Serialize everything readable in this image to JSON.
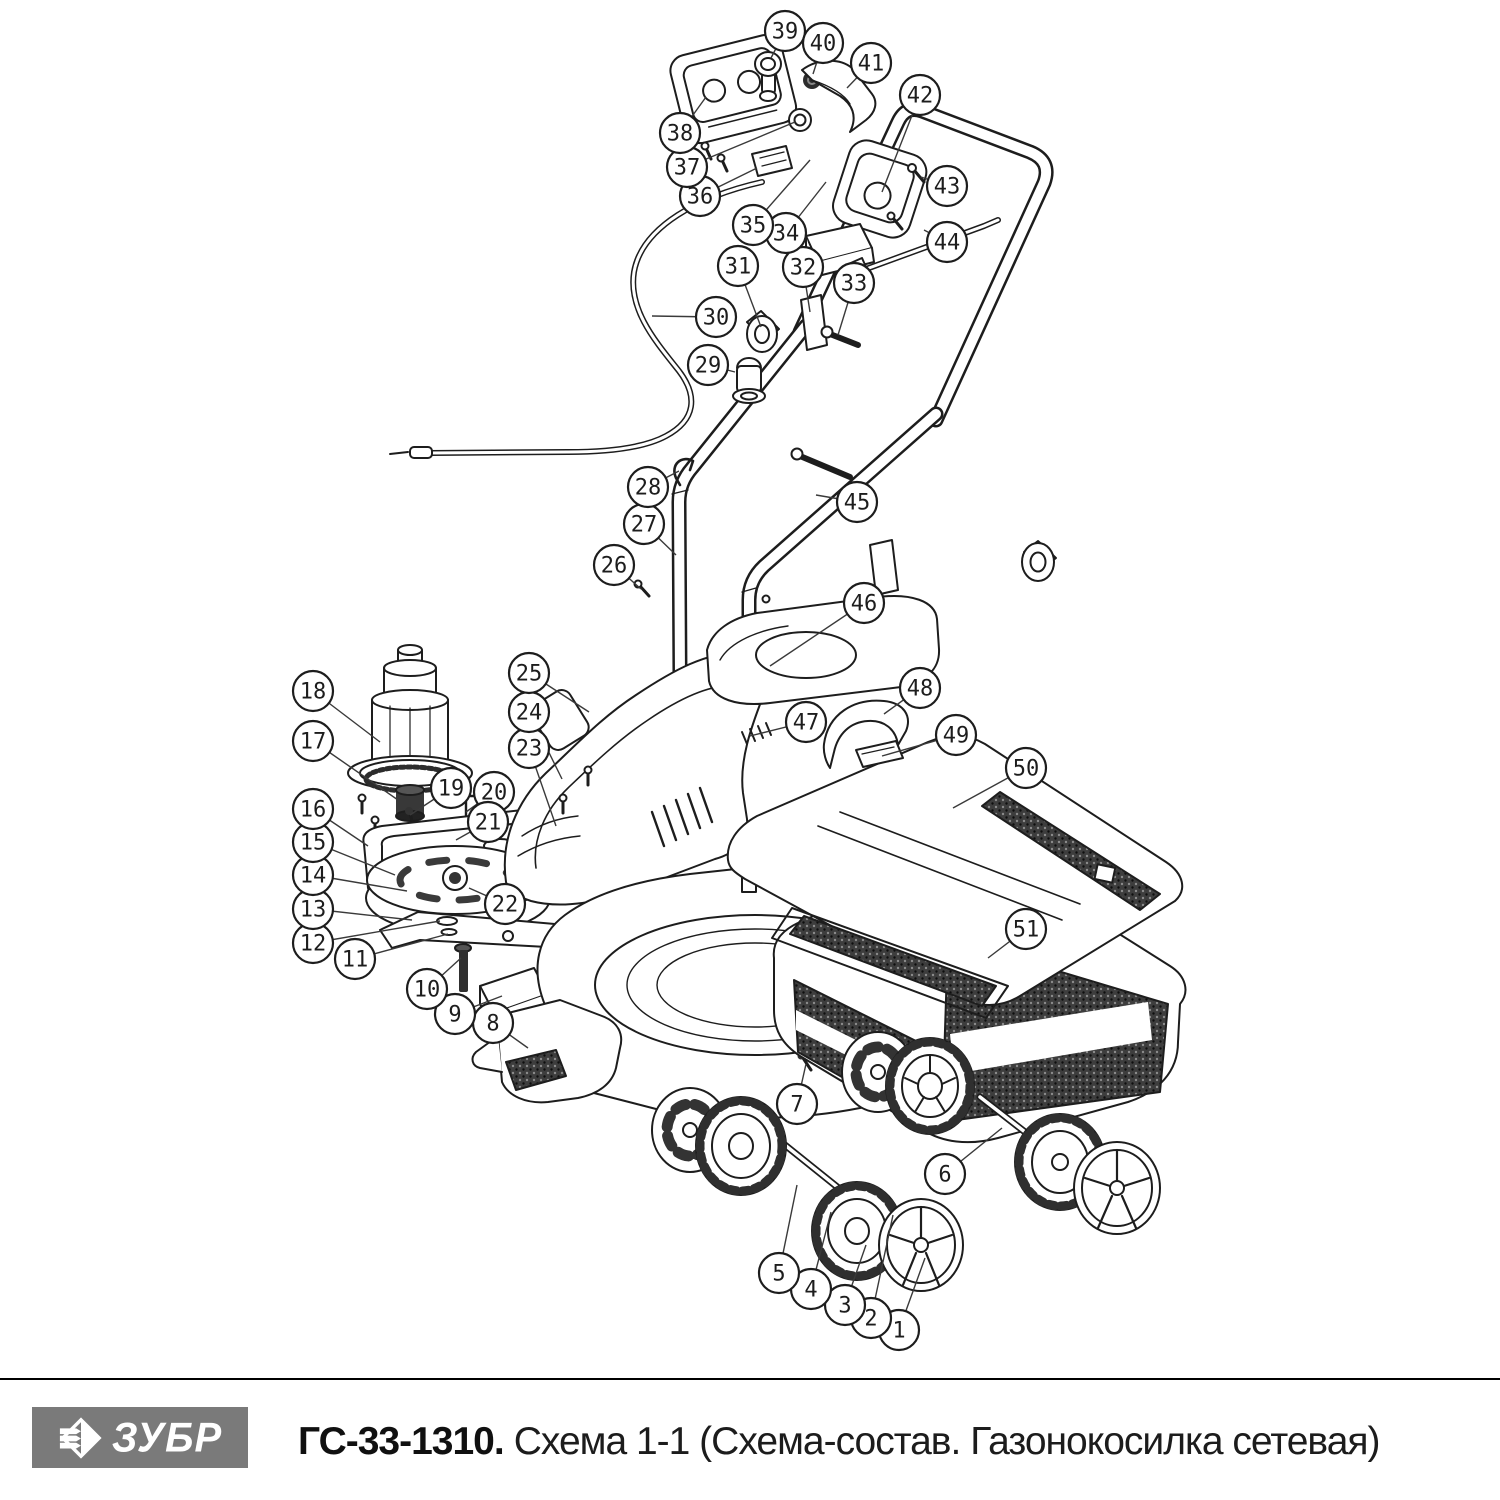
{
  "footer": {
    "brand": "ЗУБР",
    "model": "ГС-33-1310.",
    "subtitle": "Схема 1-1 (Схема-состав. Газонокосилка сетевая)",
    "logo_bg": "#7a7a7a",
    "logo_fg": "#ffffff"
  },
  "diagram": {
    "stroke_color": "#1d1d1d",
    "leader_color": "#3a3a3a",
    "callout_fill": "#ffffff",
    "callout_radius": 20,
    "callout_font_size": 22,
    "callouts": [
      {
        "n": "1",
        "cx": 899,
        "cy": 1330,
        "tx": 925,
        "ty": 1258
      },
      {
        "n": "2",
        "cx": 871,
        "cy": 1318,
        "tx": 893,
        "ty": 1215
      },
      {
        "n": "3",
        "cx": 845,
        "cy": 1305,
        "tx": 866,
        "ty": 1245
      },
      {
        "n": "4",
        "cx": 811,
        "cy": 1289,
        "tx": 831,
        "ty": 1212
      },
      {
        "n": "5",
        "cx": 779,
        "cy": 1273,
        "tx": 797,
        "ty": 1185
      },
      {
        "n": "6",
        "cx": 945,
        "cy": 1174,
        "tx": 1002,
        "ty": 1128
      },
      {
        "n": "7",
        "cx": 797,
        "cy": 1104,
        "tx": 806,
        "ty": 1064
      },
      {
        "n": "8",
        "cx": 493,
        "cy": 1023,
        "tx": 528,
        "ty": 1048
      },
      {
        "n": "9",
        "cx": 455,
        "cy": 1014,
        "tx": 502,
        "ty": 996
      },
      {
        "n": "10",
        "cx": 427,
        "cy": 989,
        "tx": 461,
        "ty": 958
      },
      {
        "n": "11",
        "cx": 355,
        "cy": 959,
        "tx": 448,
        "ty": 934
      },
      {
        "n": "12",
        "cx": 313,
        "cy": 943,
        "tx": 440,
        "ty": 921
      },
      {
        "n": "13",
        "cx": 313,
        "cy": 909,
        "tx": 412,
        "ty": 920
      },
      {
        "n": "14",
        "cx": 313,
        "cy": 875,
        "tx": 407,
        "ty": 891
      },
      {
        "n": "15",
        "cx": 313,
        "cy": 842,
        "tx": 395,
        "ty": 875
      },
      {
        "n": "16",
        "cx": 313,
        "cy": 809,
        "tx": 368,
        "ty": 846
      },
      {
        "n": "17",
        "cx": 313,
        "cy": 741,
        "tx": 398,
        "ty": 800
      },
      {
        "n": "18",
        "cx": 313,
        "cy": 691,
        "tx": 380,
        "ty": 742
      },
      {
        "n": "19",
        "cx": 451,
        "cy": 788,
        "tx": 410,
        "ty": 815
      },
      {
        "n": "20",
        "cx": 494,
        "cy": 792,
        "tx": 466,
        "ty": 812
      },
      {
        "n": "21",
        "cx": 488,
        "cy": 822,
        "tx": 456,
        "ty": 840
      },
      {
        "n": "22",
        "cx": 505,
        "cy": 904,
        "tx": 469,
        "ty": 888
      },
      {
        "n": "23",
        "cx": 529,
        "cy": 748,
        "tx": 556,
        "ty": 826
      },
      {
        "n": "24",
        "cx": 529,
        "cy": 712,
        "tx": 562,
        "ty": 779
      },
      {
        "n": "25",
        "cx": 529,
        "cy": 673,
        "tx": 589,
        "ty": 712
      },
      {
        "n": "26",
        "cx": 614,
        "cy": 565,
        "tx": 641,
        "ty": 589
      },
      {
        "n": "27",
        "cx": 644,
        "cy": 524,
        "tx": 676,
        "ty": 555
      },
      {
        "n": "28",
        "cx": 648,
        "cy": 487,
        "tx": 679,
        "ty": 471
      },
      {
        "n": "29",
        "cx": 708,
        "cy": 365,
        "tx": 735,
        "ty": 372
      },
      {
        "n": "30",
        "cx": 716,
        "cy": 317,
        "tx": 652,
        "ty": 316
      },
      {
        "n": "31",
        "cx": 738,
        "cy": 266,
        "tx": 761,
        "ty": 327
      },
      {
        "n": "32",
        "cx": 803,
        "cy": 267,
        "tx": 810,
        "ty": 312
      },
      {
        "n": "33",
        "cx": 854,
        "cy": 283,
        "tx": 838,
        "ty": 335
      },
      {
        "n": "34",
        "cx": 786,
        "cy": 233,
        "tx": 826,
        "ty": 182
      },
      {
        "n": "35",
        "cx": 753,
        "cy": 225,
        "tx": 810,
        "ty": 160
      },
      {
        "n": "36",
        "cx": 700,
        "cy": 196,
        "tx": 757,
        "ty": 168
      },
      {
        "n": "37",
        "cx": 687,
        "cy": 167,
        "tx": 795,
        "ty": 122
      },
      {
        "n": "38",
        "cx": 680,
        "cy": 133,
        "tx": 706,
        "ty": 97
      },
      {
        "n": "39",
        "cx": 785,
        "cy": 31,
        "tx": 771,
        "ty": 58
      },
      {
        "n": "40",
        "cx": 823,
        "cy": 43,
        "tx": 813,
        "ty": 74
      },
      {
        "n": "41",
        "cx": 871,
        "cy": 63,
        "tx": 847,
        "ty": 88
      },
      {
        "n": "42",
        "cx": 920,
        "cy": 95,
        "tx": 882,
        "ty": 192
      },
      {
        "n": "43",
        "cx": 947,
        "cy": 186,
        "tx": 921,
        "ty": 177
      },
      {
        "n": "44",
        "cx": 947,
        "cy": 242,
        "tx": 924,
        "ty": 230
      },
      {
        "n": "45",
        "cx": 857,
        "cy": 502,
        "tx": 816,
        "ty": 495
      },
      {
        "n": "46",
        "cx": 864,
        "cy": 603,
        "tx": 770,
        "ty": 666
      },
      {
        "n": "47",
        "cx": 806,
        "cy": 722,
        "tx": 750,
        "ty": 736
      },
      {
        "n": "48",
        "cx": 920,
        "cy": 688,
        "tx": 884,
        "ty": 714
      },
      {
        "n": "49",
        "cx": 956,
        "cy": 735,
        "tx": 882,
        "ty": 756
      },
      {
        "n": "50",
        "cx": 1026,
        "cy": 768,
        "tx": 953,
        "ty": 808
      },
      {
        "n": "51",
        "cx": 1026,
        "cy": 929,
        "tx": 988,
        "ty": 958
      }
    ]
  }
}
